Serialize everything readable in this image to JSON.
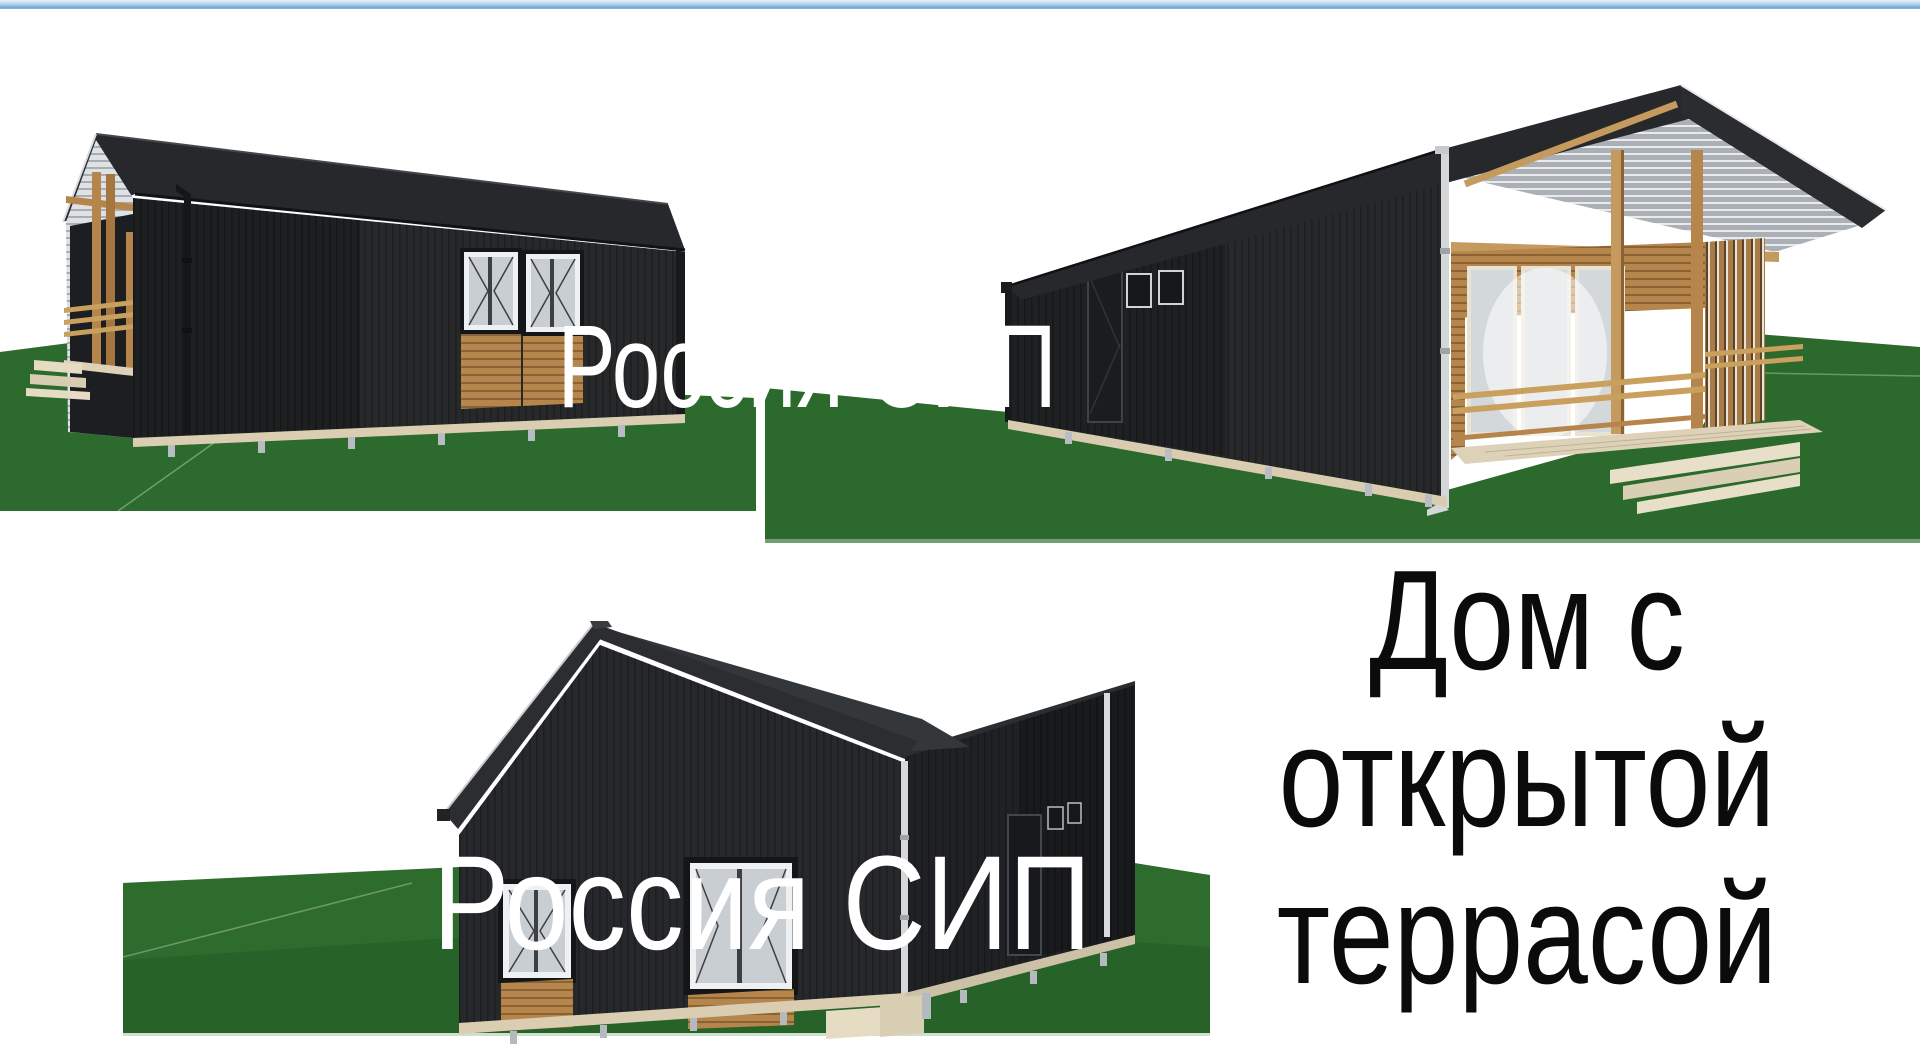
{
  "meta": {
    "kind": "real-estate-render-collage",
    "width_px": 1920,
    "height_px": 1050
  },
  "watermarks": {
    "top": "Россия СИП",
    "bottom": "Россия СИП"
  },
  "caption": {
    "line1": "Дом с",
    "line2": "открытой",
    "line3": "террасой",
    "full": "Дом с открытой террасой"
  },
  "renders": [
    {
      "id": "top-left",
      "alt": "Black SIP-panel house with corner wooden porch, view along the side wall"
    },
    {
      "id": "top-right",
      "alt": "Black SIP-panel house with open timber terrace under the gable end"
    },
    {
      "id": "bottom",
      "alt": "Black SIP-panel gable house with white-framed windows and wood panels"
    }
  ],
  "palette": {
    "pageBg": "#ffffff",
    "topBarBlue": "#8fbcdd",
    "watermark": "#ffffff",
    "caption": "#0b0b0b",
    "grass": "#2d6a2d",
    "grassDark": "#1f5a23",
    "wallDark": "#26282b",
    "roofDark": "#2b2d30",
    "wood": "#b5854b",
    "woodLight": "#caa05e",
    "glass": "#c9ced3",
    "frameWhite": "#eef0f2",
    "foundation": "#dacdb2",
    "pierGray": "#b7bdc2"
  }
}
